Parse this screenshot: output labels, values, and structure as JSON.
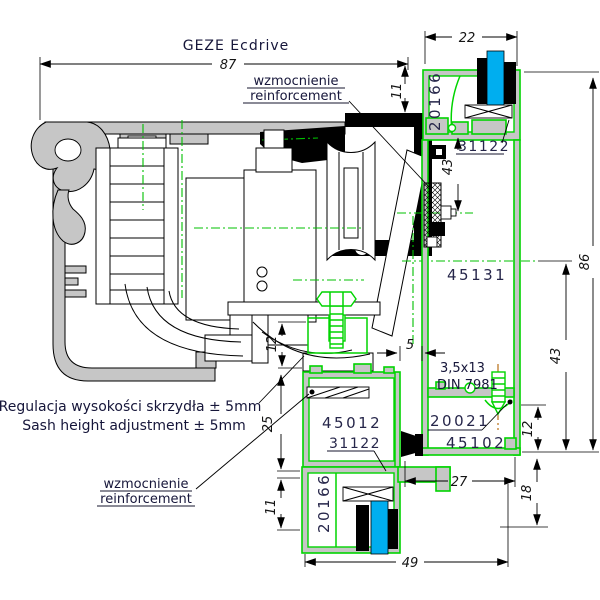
{
  "drawing": {
    "title": "GEZE Ecdrive",
    "notes": {
      "reinforcement_pl": "wzmocnienie",
      "reinforcement_en": "reinforcement",
      "adjustment_pl": "Regulacja wysokości skrzydła ± 5mm",
      "adjustment_en": "Sash height adjustment ± 5mm",
      "screw_size": "3,5x13",
      "screw_standard": "DIN 7981"
    },
    "profiles": {
      "frame_glazing_top": "20166",
      "gasket_top": "31122",
      "frame_mullion": "45131",
      "glazing_bead": "20021",
      "frame_bottom": "45102",
      "sash": "45012",
      "gasket_bottom": "31122",
      "sash_glazing_bottom": "20166"
    },
    "dimensions": {
      "overall_width": "87",
      "frame_top_width": "22",
      "top_offset": "11",
      "overall_height": "86",
      "frame_right_height": "43",
      "lock_height": "43",
      "bead_chamber": "12",
      "bottom_offset": "18",
      "frame_bottom_width": "27",
      "sash_width": "49",
      "gap": "5",
      "clamp_height": "12",
      "sash_top_height": "25",
      "sash_bottom_height": "11"
    },
    "colors": {
      "profile_green": "#00d400",
      "brush_cyan": "#00aeef",
      "aluminum_gray": "#c6c6c6",
      "centerline_green": "#00c000",
      "screw_centerline": "#b06000",
      "line_black": "#000000",
      "label_ink": "#26264a"
    }
  }
}
